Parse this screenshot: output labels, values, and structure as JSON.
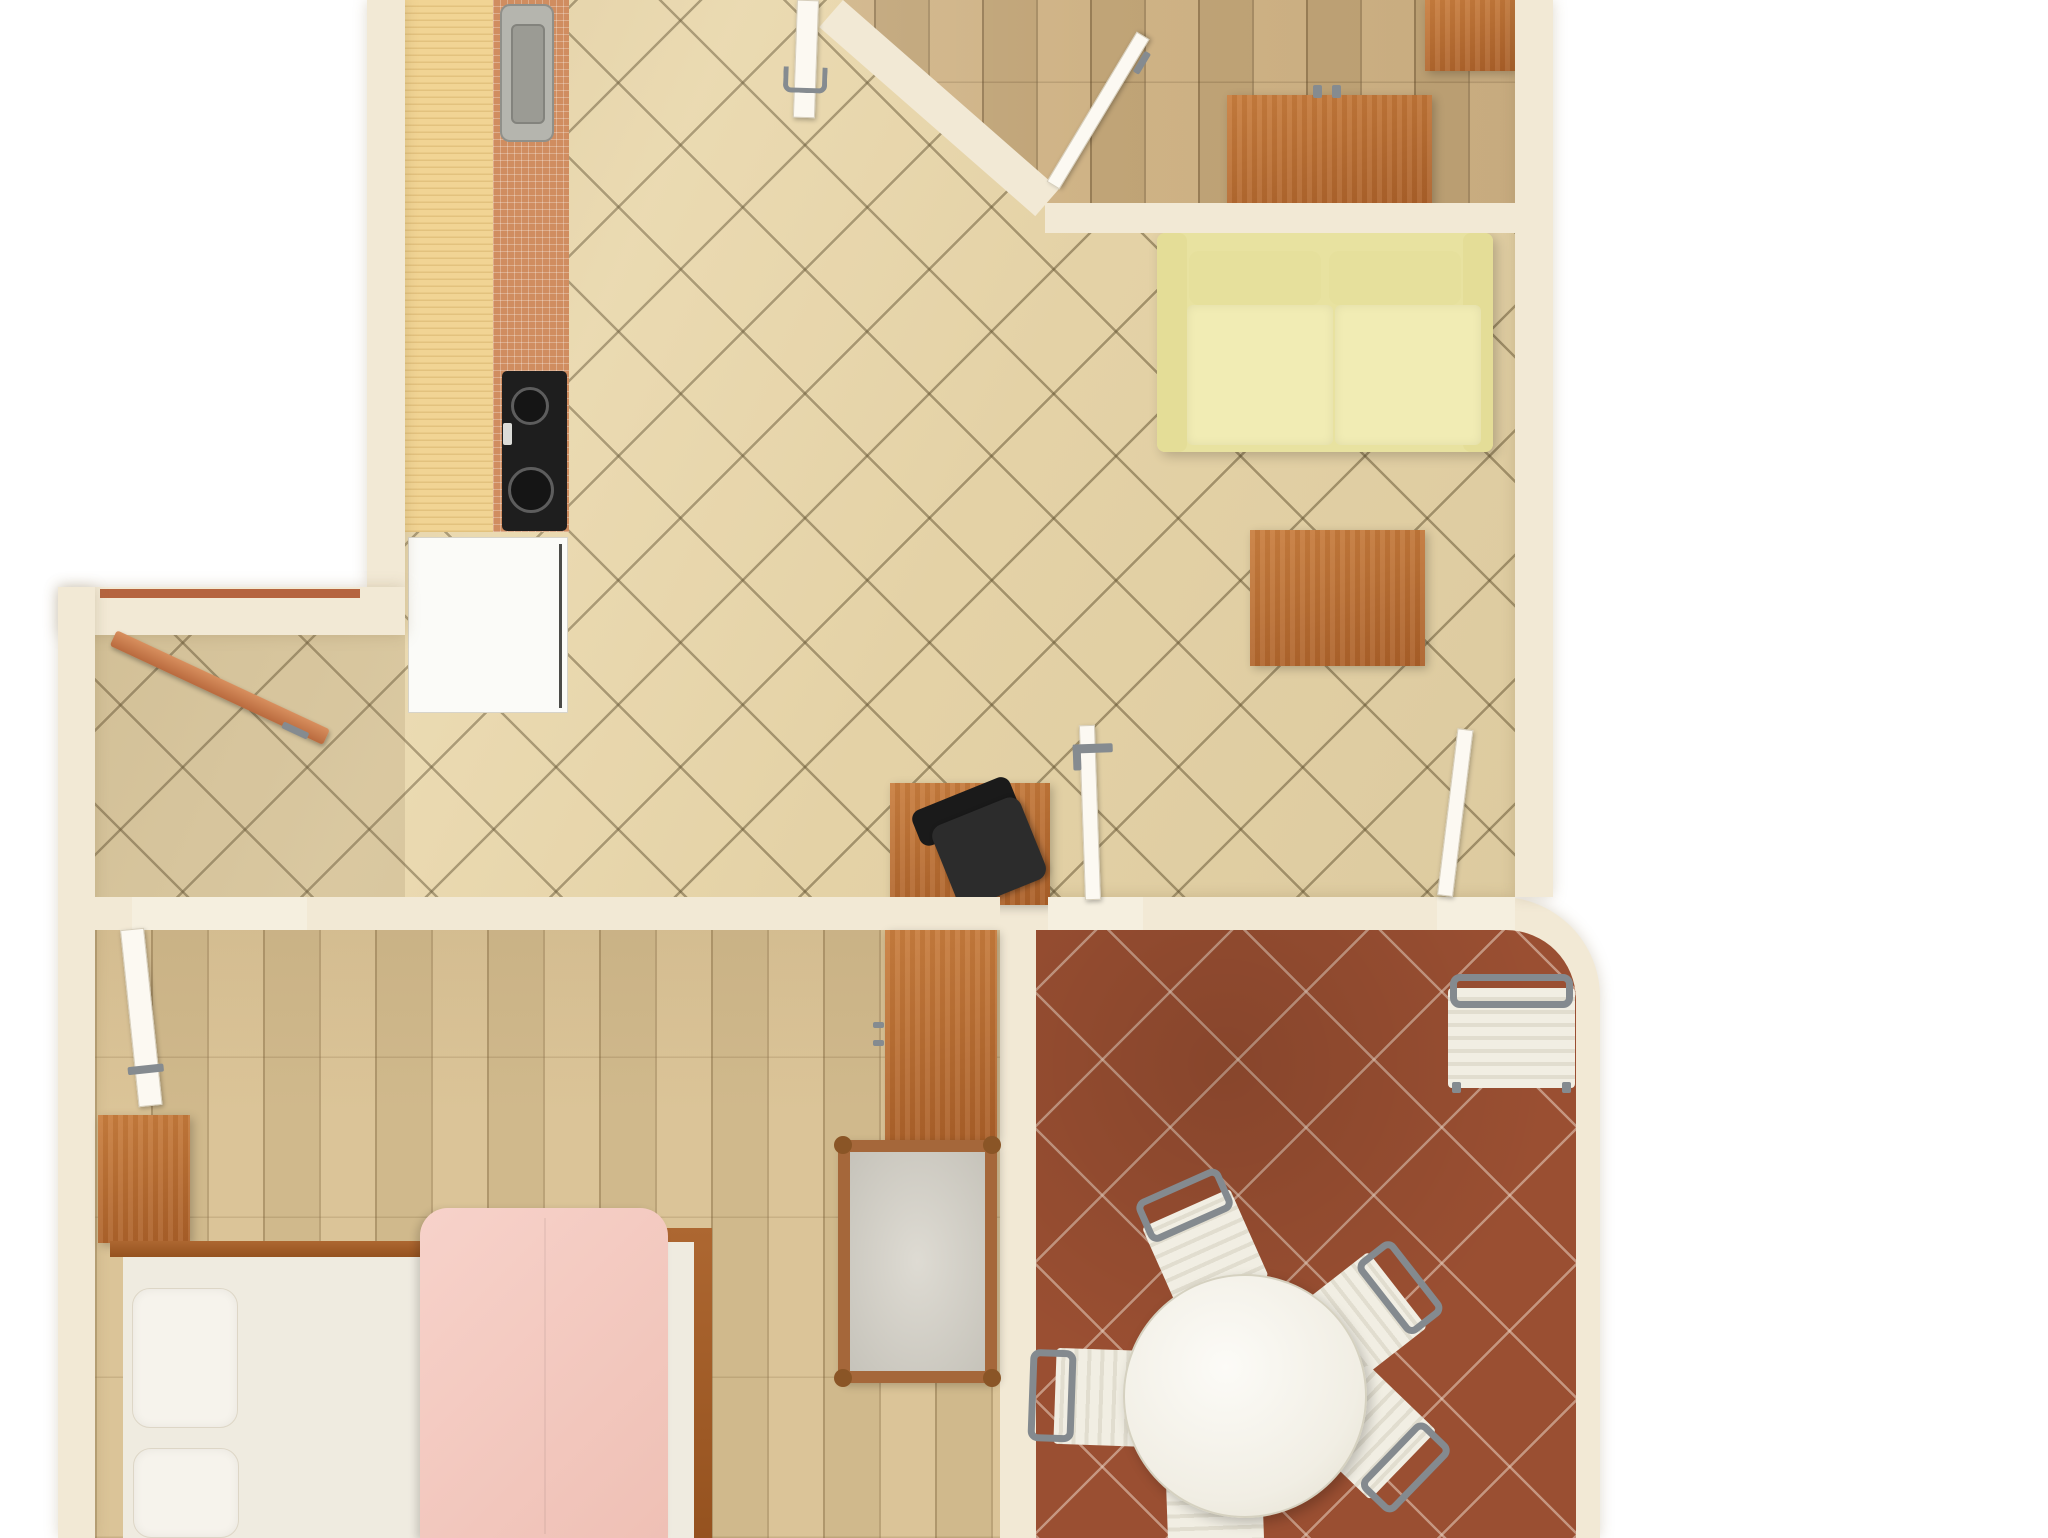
{
  "scene": {
    "type": "apartment-floor-plan-3d-render",
    "width": 2048,
    "height": 1538,
    "background": "#ffffff"
  },
  "palette": {
    "outside": "#ffffff",
    "wall": "#f2e9d5",
    "tile_beige": "#e9d7ab",
    "tile_grout": "#62522f",
    "terracotta": "#9a4f32",
    "terracotta_grout": "#e8d1c0",
    "parquet_office": "#ccae7e",
    "parquet_bedroom": "#d9c192",
    "counter_wood": "#f1d494",
    "backsplash_tile": "#d08d60",
    "appliance_white": "#fbfbf8",
    "stove_black": "#1e1e1e",
    "furniture_wood": "#b9742f",
    "sofa_yellow": "#eae4a4",
    "seat_cream": "#f1eee3",
    "metal_gray": "#858b90",
    "bed_pink": "#f4c9c0",
    "linen_white": "#efebe0",
    "door_white": "#fcf9f2",
    "door_wood": "#c97e50"
  },
  "rooms": [
    {
      "name": "kitchen-living-area",
      "floor": "beige-diagonal-tile"
    },
    {
      "name": "entry-hallway",
      "floor": "beige-diagonal-tile"
    },
    {
      "name": "office-room",
      "floor": "light-parquet"
    },
    {
      "name": "bedroom",
      "floor": "light-parquet"
    },
    {
      "name": "dining-room",
      "floor": "terracotta-diagonal-tile"
    }
  ],
  "items": [
    {
      "n": "floor-living-area",
      "c": "tile-beige",
      "x": 95,
      "y": 0,
      "w": 1420,
      "h": 930,
      "clip": "polygon(310px 0px, 1420px 0px, 1420px 930px, 0px 930px, 0px 635px, 310px 635px)"
    },
    {
      "n": "floor-office-room",
      "c": "parquet-office",
      "x": 820,
      "y": 0,
      "w": 695,
      "h": 233,
      "clip": "polygon(23px 0px, 695px 0px, 695px 233px, 255px 233px)"
    },
    {
      "n": "dining-room-walls",
      "c": "wall",
      "x": 1000,
      "y": 897,
      "w": 600,
      "h": 641,
      "r": "0 100px 0 0",
      "sh": "0 0 14px rgba(140,120,80,.28)"
    },
    {
      "n": "floor-dining-room",
      "c": "tile-terra",
      "x": 1036,
      "y": 930,
      "w": 540,
      "h": 608,
      "r": "0 70px 0 0"
    },
    {
      "n": "floor-bedroom",
      "c": "parquet-bed",
      "x": 95,
      "y": 930,
      "w": 905,
      "h": 608
    },
    {
      "n": "hallway-shadow",
      "c": "shade",
      "x": 95,
      "y": 635,
      "w": 310,
      "h": 262,
      "bg": "rgba(95,78,45,.12)"
    },
    {
      "n": "kitchen-counter",
      "c": "counter-wood",
      "x": 405,
      "y": 0,
      "w": 88,
      "h": 532
    },
    {
      "n": "kitchen-backsplash-tiles",
      "c": "tile-strip",
      "x": 493,
      "y": 0,
      "w": 76,
      "h": 532
    },
    {
      "n": "kitchen-sink",
      "c": "sink",
      "x": 500,
      "y": 4,
      "w": 54,
      "h": 138,
      "ch": [
        {
          "n": "sink-basin",
          "c": "sink-basin",
          "x": 9,
          "y": 18,
          "w": 34,
          "h": 100
        }
      ]
    },
    {
      "n": "kitchen-stove",
      "c": "stove",
      "x": 502,
      "y": 371,
      "w": 65,
      "h": 160,
      "ch": [
        {
          "n": "stove-burner-small",
          "c": "burner",
          "x": 9,
          "y": 16,
          "w": 38,
          "h": 38
        },
        {
          "n": "stove-burner-large",
          "c": "burner",
          "x": 6,
          "y": 96,
          "w": 46,
          "h": 46
        },
        {
          "n": "stove-dial",
          "c": "dial",
          "x": 1,
          "y": 52,
          "w": 9,
          "h": 22
        }
      ]
    },
    {
      "n": "kitchen-fridge",
      "c": "fridge",
      "x": 408,
      "y": 537,
      "w": 160,
      "h": 176,
      "ch": [
        {
          "n": "fridge-door-line",
          "c": "dark-line",
          "x": 150,
          "y": 6,
          "w": 3,
          "h": 164
        }
      ]
    },
    {
      "n": "sofa",
      "x": 1157,
      "y": 233,
      "w": 336,
      "h": 219,
      "ch": [
        {
          "n": "sofa-base",
          "c": "sofa-base",
          "x": 0,
          "y": 0,
          "w": 336,
          "h": 219
        },
        {
          "n": "sofa-armrest-left",
          "x": 0,
          "y": 0,
          "w": 30,
          "h": 219,
          "bg": "#e4dd97",
          "r": "8px"
        },
        {
          "n": "sofa-armrest-right",
          "x": 306,
          "y": 0,
          "w": 30,
          "h": 219,
          "bg": "#e4dd97",
          "r": "8px"
        },
        {
          "n": "sofa-back-cushion-left",
          "c": "sofa-back",
          "x": 32,
          "y": 18,
          "w": 132,
          "h": 54
        },
        {
          "n": "sofa-back-cushion-right",
          "c": "sofa-back",
          "x": 172,
          "y": 18,
          "w": 132,
          "h": 54
        },
        {
          "n": "sofa-seat-cushion-left",
          "c": "sofa-cushion",
          "x": 30,
          "y": 72,
          "w": 146,
          "h": 140
        },
        {
          "n": "sofa-seat-cushion-right",
          "c": "sofa-cushion",
          "x": 178,
          "y": 72,
          "w": 146,
          "h": 140
        }
      ]
    },
    {
      "n": "coffee-table",
      "c": "wood",
      "x": 1250,
      "y": 530,
      "w": 175,
      "h": 136
    },
    {
      "n": "desk",
      "c": "wood",
      "x": 890,
      "y": 783,
      "w": 160,
      "h": 122
    },
    {
      "n": "office-chair",
      "x": 915,
      "y": 780,
      "w": 125,
      "h": 125,
      "rot": -22,
      "ch": [
        {
          "n": "office-chair-backrest",
          "c": "chair-black-back",
          "x": 10,
          "y": 10,
          "w": 105,
          "h": 38
        },
        {
          "n": "office-chair-seat",
          "c": "chair-black-seat",
          "x": 22,
          "y": 32,
          "w": 95,
          "h": 88
        }
      ]
    },
    {
      "n": "office-dresser",
      "c": "wood",
      "x": 1227,
      "y": 95,
      "w": 205,
      "h": 112,
      "ch": [
        {
          "n": "office-dresser-knob-left",
          "c": "handle",
          "x": 86,
          "y": -10,
          "w": 9,
          "h": 13
        },
        {
          "n": "office-dresser-knob-right",
          "c": "handle",
          "x": 105,
          "y": -10,
          "w": 9,
          "h": 13
        }
      ]
    },
    {
      "n": "office-corner-cabinet",
      "c": "wood",
      "x": 1425,
      "y": 0,
      "w": 90,
      "h": 71
    },
    {
      "n": "wall-left-top",
      "c": "wall",
      "x": 367,
      "y": 0,
      "w": 38,
      "h": 587,
      "sh": "0 0 14px rgba(140,120,80,.28)"
    },
    {
      "n": "wall-right",
      "c": "wall",
      "x": 1515,
      "y": 0,
      "w": 38,
      "h": 897,
      "sh": "0 0 14px rgba(140,120,80,.28)"
    },
    {
      "n": "wall-office-bottom",
      "c": "wall",
      "x": 1045,
      "y": 203,
      "w": 470,
      "h": 30
    },
    {
      "n": "wall-office-diagonal",
      "c": "wall",
      "x": 843,
      "y": 0,
      "w": 287,
      "h": 36,
      "rot": 41.2,
      "o": "0 0"
    },
    {
      "n": "wall-hallway-top",
      "c": "wall",
      "x": 58,
      "y": 587,
      "w": 347,
      "h": 48,
      "sh": "0 0 14px rgba(140,120,80,.28)"
    },
    {
      "n": "hallway-window",
      "c": "window-line",
      "x": 100,
      "y": 589,
      "w": 260,
      "h": 9
    },
    {
      "n": "wall-left-lower",
      "c": "wall",
      "x": 58,
      "y": 587,
      "w": 37,
      "h": 951,
      "sh": "0 0 14px rgba(140,120,80,.28)"
    },
    {
      "n": "wall-bottom-left-stub",
      "c": "wall",
      "x": 95,
      "y": 897,
      "w": 37,
      "h": 33
    },
    {
      "n": "wall-bottom-main",
      "c": "wall",
      "x": 307,
      "y": 897,
      "w": 693,
      "h": 33
    },
    {
      "n": "threshold-bedroom-door",
      "c": "threshold",
      "x": 132,
      "y": 897,
      "w": 175,
      "h": 33
    },
    {
      "n": "threshold-dining-door-left",
      "c": "threshold",
      "x": 1048,
      "y": 897,
      "w": 95,
      "h": 33
    },
    {
      "n": "threshold-dining-door-right",
      "c": "threshold",
      "x": 1437,
      "y": 897,
      "w": 78,
      "h": 33
    },
    {
      "n": "wardrobe",
      "c": "wood",
      "x": 885,
      "y": 930,
      "w": 112,
      "h": 210,
      "ch": [
        {
          "n": "wardrobe-handle-top",
          "c": "handle",
          "x": -12,
          "y": 92,
          "w": 11,
          "h": 6
        },
        {
          "n": "wardrobe-handle-bottom",
          "c": "handle",
          "x": -12,
          "y": 110,
          "w": 11,
          "h": 6
        }
      ]
    },
    {
      "n": "crib-bench",
      "c": "crib",
      "x": 838,
      "y": 1140,
      "w": 159,
      "h": 243,
      "ch": [
        {
          "n": "crib-knob-tl",
          "c": "knob",
          "x": -16,
          "y": -16,
          "w": 18,
          "h": 18
        },
        {
          "n": "crib-knob-tr",
          "c": "knob",
          "x": 133,
          "y": -16,
          "w": 18,
          "h": 18
        },
        {
          "n": "crib-knob-bl",
          "c": "knob",
          "x": -16,
          "y": 217,
          "w": 18,
          "h": 18
        },
        {
          "n": "crib-knob-br",
          "c": "knob",
          "x": 133,
          "y": 217,
          "w": 18,
          "h": 18
        }
      ]
    },
    {
      "n": "bedside-dresser",
      "c": "wood",
      "x": 98,
      "y": 1115,
      "w": 92,
      "h": 128
    },
    {
      "n": "bed-rail-top",
      "c": "rail",
      "x": 110,
      "y": 1241,
      "w": 320,
      "h": 16
    },
    {
      "n": "bed-rail-right",
      "c": "rail",
      "x": 665,
      "y": 1228,
      "w": 47,
      "h": 310
    },
    {
      "n": "bed-mattress-edge",
      "c": "mattress",
      "x": 668,
      "y": 1242,
      "w": 26,
      "h": 296
    },
    {
      "n": "bed-sheet",
      "c": "mattress",
      "x": 123,
      "y": 1257,
      "w": 308,
      "h": 281
    },
    {
      "n": "bed-pillow-top",
      "c": "pillow",
      "x": 132,
      "y": 1288,
      "w": 106,
      "h": 140
    },
    {
      "n": "bed-pillow-bottom",
      "c": "pillow",
      "x": 133,
      "y": 1448,
      "w": 106,
      "h": 90
    },
    {
      "n": "bed-duvet",
      "c": "duvet",
      "x": 420,
      "y": 1208,
      "w": 248,
      "h": 330,
      "ch": [
        {
          "n": "duvet-seam",
          "x": 124,
          "y": 10,
          "w": 2,
          "h": 316,
          "bg": "rgba(0,0,0,.05)"
        }
      ]
    },
    {
      "n": "dining-sideboard",
      "x": 1448,
      "y": 974,
      "w": 127,
      "h": 121,
      "ch": [
        {
          "n": "sideboard-body",
          "c": "striped",
          "x": 0,
          "y": 14,
          "w": 127,
          "h": 100
        },
        {
          "n": "sideboard-frame",
          "c": "chair-frame",
          "x": 2,
          "y": 0,
          "w": 123,
          "h": 34
        },
        {
          "n": "sideboard-foot-left",
          "c": "handle",
          "x": 4,
          "y": 108,
          "w": 9,
          "h": 11
        },
        {
          "n": "sideboard-foot-right",
          "c": "handle",
          "x": 114,
          "y": 108,
          "w": 9,
          "h": 11
        }
      ]
    },
    {
      "n": "dining-chair-top",
      "x": 1152,
      "y": 1179,
      "w": 96,
      "h": 122,
      "rot": -24,
      "ch": [
        {
          "n": "chair-seat",
          "c": "striped",
          "x": 0,
          "y": 26,
          "w": 96,
          "h": 96
        },
        {
          "n": "chair-back-frame",
          "c": "chair-frame",
          "x": 2,
          "y": 0,
          "w": 92,
          "h": 46
        }
      ]
    },
    {
      "n": "dining-chair-right",
      "x": 1322,
      "y": 1250,
      "w": 96,
      "h": 122,
      "rot": 52,
      "ch": [
        {
          "n": "chair-seat",
          "c": "striped",
          "x": 0,
          "y": 26,
          "w": 96,
          "h": 96
        },
        {
          "n": "chair-back-frame",
          "c": "chair-frame",
          "x": 2,
          "y": 0,
          "w": 92,
          "h": 46
        }
      ]
    },
    {
      "n": "dining-chair-left",
      "x": 1042,
      "y": 1336,
      "w": 96,
      "h": 122,
      "rot": -88,
      "ch": [
        {
          "n": "chair-seat",
          "c": "striped",
          "x": 0,
          "y": 26,
          "w": 96,
          "h": 96
        },
        {
          "n": "chair-back-frame",
          "c": "chair-frame",
          "x": 2,
          "y": 0,
          "w": 92,
          "h": 46
        }
      ]
    },
    {
      "n": "dining-chair-bottom-right",
      "x": 1330,
      "y": 1380,
      "w": 96,
      "h": 122,
      "rot": 134,
      "ch": [
        {
          "n": "chair-seat",
          "c": "striped",
          "x": 0,
          "y": 26,
          "w": 96,
          "h": 96
        },
        {
          "n": "chair-back-frame",
          "c": "chair-frame",
          "x": 2,
          "y": 0,
          "w": 92,
          "h": 46
        }
      ]
    },
    {
      "n": "dining-chair-bottom",
      "x": 1168,
      "y": 1478,
      "w": 96,
      "h": 122,
      "rot": 178,
      "ch": [
        {
          "n": "chair-seat",
          "c": "striped",
          "x": 0,
          "y": 26,
          "w": 96,
          "h": 96
        },
        {
          "n": "chair-back-frame",
          "c": "chair-frame",
          "x": 2,
          "y": 0,
          "w": 92,
          "h": 46
        }
      ]
    },
    {
      "n": "dining-table",
      "c": "table-round",
      "x": 1123,
      "y": 1274,
      "w": 244,
      "h": 244
    },
    {
      "n": "entry-door",
      "c": "door-wood",
      "x": 113,
      "y": 632,
      "w": 235,
      "h": 17,
      "rot": 25,
      "o": "6px 8px",
      "ch": [
        {
          "n": "entry-door-handle",
          "c": "handle",
          "x": 190,
          "y": 12,
          "w": 28,
          "h": 7
        }
      ]
    },
    {
      "n": "top-door",
      "c": "door-white",
      "x": 797,
      "y": 0,
      "w": 22,
      "h": 118,
      "rot": 2,
      "o": "50% 0%",
      "ch": [
        {
          "n": "top-door-handle",
          "c": "handle-u",
          "x": -12,
          "y": 66,
          "w": 44,
          "h": 26
        }
      ]
    },
    {
      "n": "office-door",
      "c": "door-white",
      "x": 1053,
      "y": 178,
      "w": 175,
      "h": 15,
      "rot": -59,
      "o": "0% 50%",
      "ch": [
        {
          "n": "office-door-handle",
          "c": "handle",
          "x": 138,
          "y": 16,
          "w": 24,
          "h": 7
        }
      ]
    },
    {
      "n": "bedroom-door",
      "c": "door-white",
      "x": 120,
      "y": 929,
      "w": 24,
      "h": 178,
      "rot": -6,
      "o": "50% 0%",
      "ch": [
        {
          "n": "bedroom-door-handle",
          "c": "handle",
          "x": -8,
          "y": 136,
          "w": 36,
          "h": 8
        }
      ]
    },
    {
      "n": "dining-door-left-leaf",
      "c": "door-white",
      "x": 1085,
      "y": 725,
      "w": 16,
      "h": 175,
      "rot": -2,
      "o": "50% 100%",
      "ch": [
        {
          "n": "dining-door-left-handle",
          "c": "handle",
          "x": -8,
          "y": 18,
          "w": 40,
          "h": 9
        },
        {
          "n": "dining-door-left-handle-2",
          "c": "handle",
          "x": -8,
          "y": 18,
          "w": 8,
          "h": 26
        }
      ]
    },
    {
      "n": "dining-door-right-leaf",
      "c": "door-white",
      "x": 1437,
      "y": 728,
      "w": 16,
      "h": 168,
      "rot": 7,
      "o": "50% 100%"
    }
  ]
}
